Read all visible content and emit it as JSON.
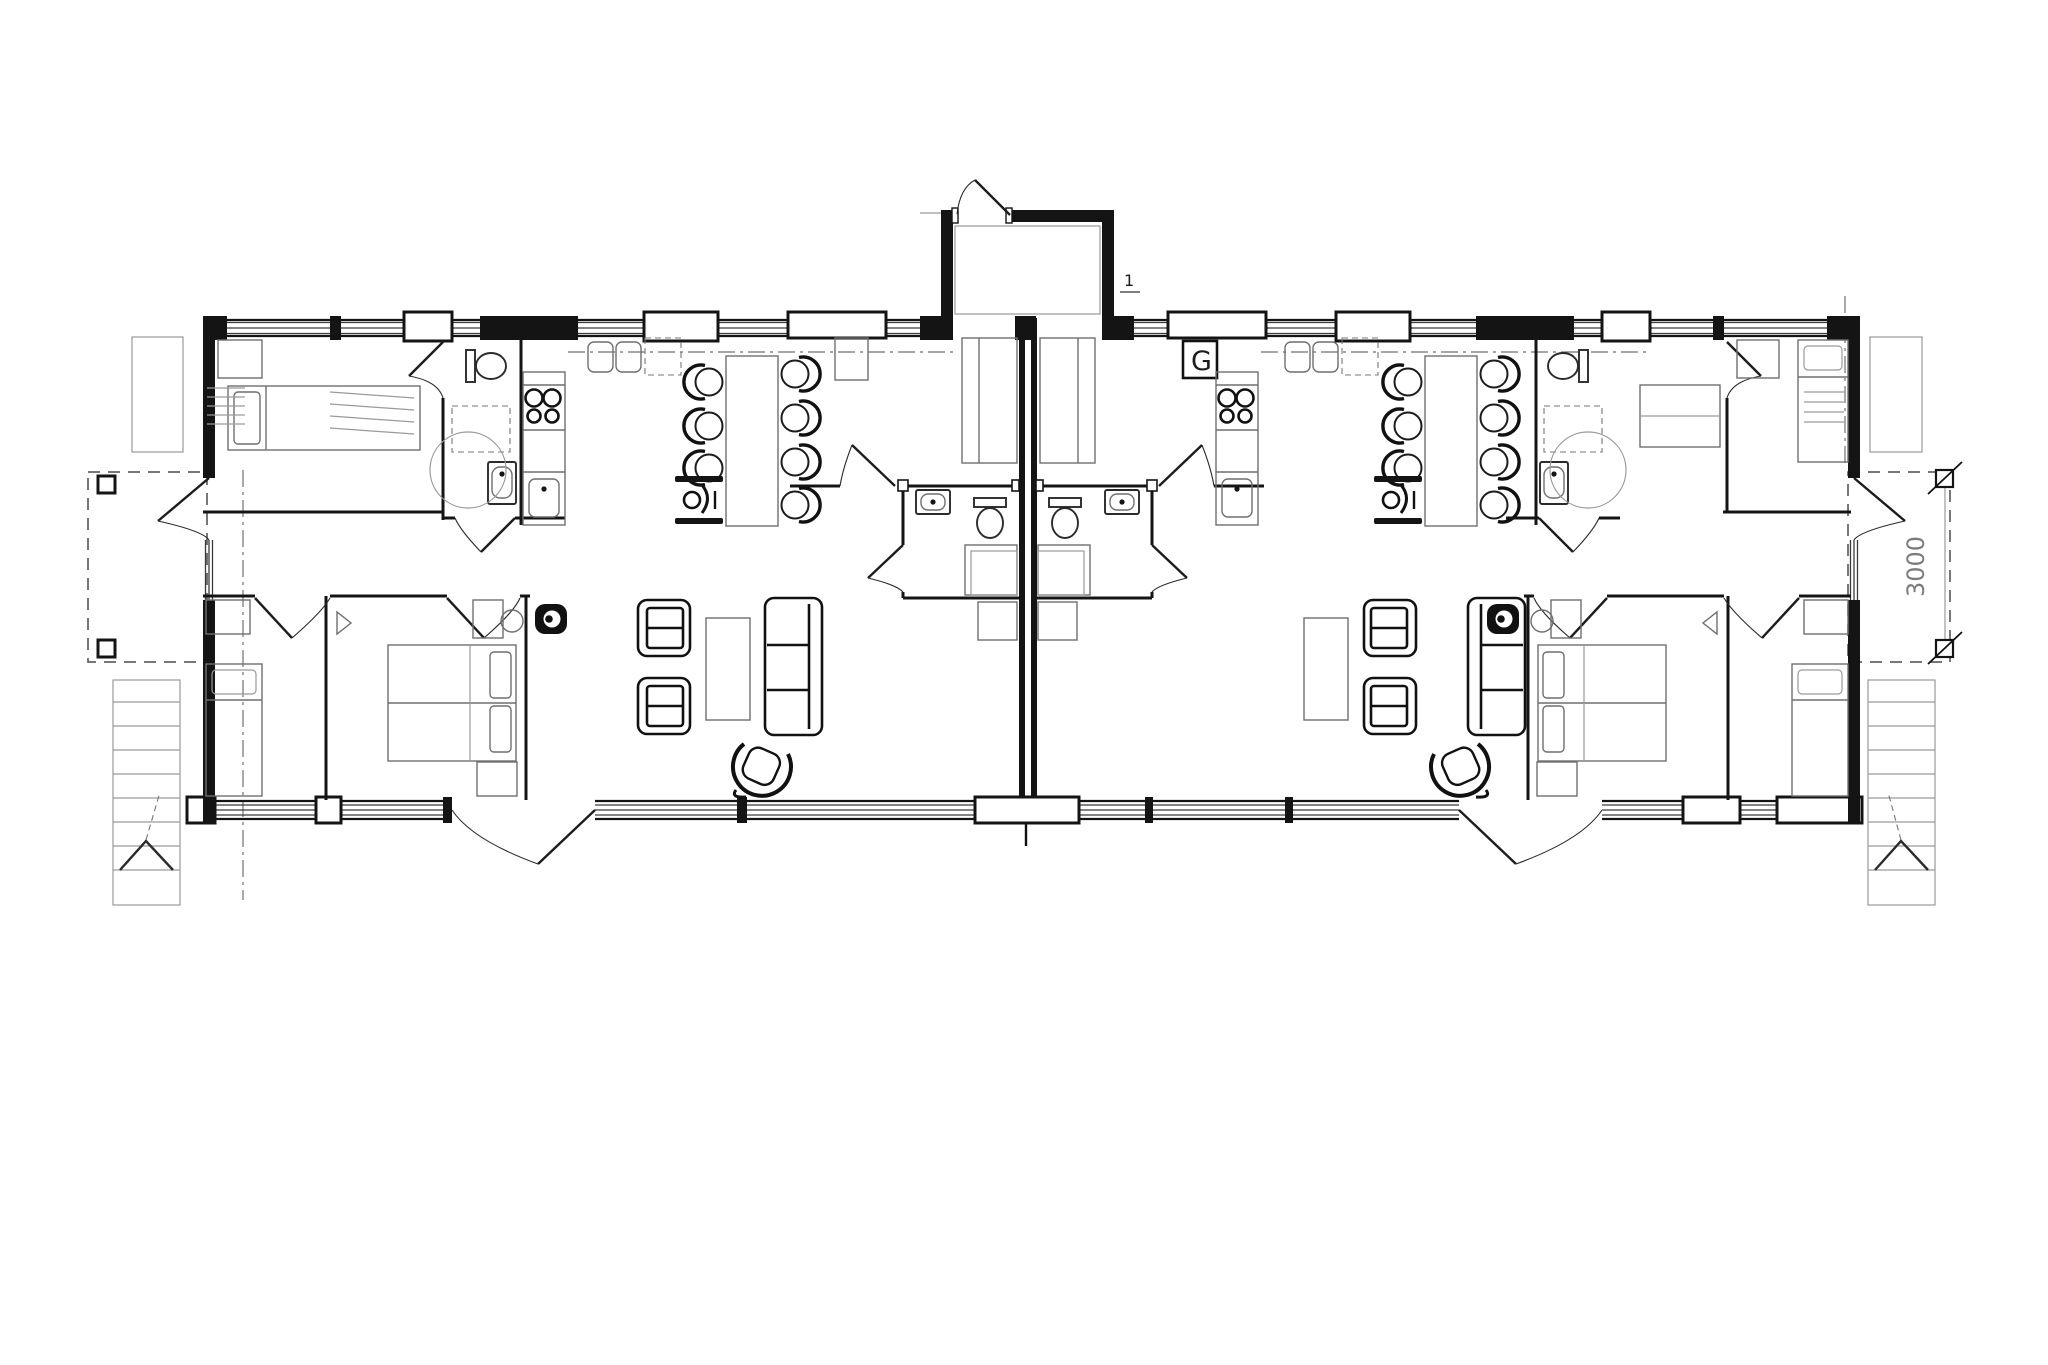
{
  "drawing": {
    "type": "architectural-floor-plan",
    "labels": {
      "wardrobe_right": "G",
      "deck_depth": "3000",
      "door_mark": "1"
    },
    "symbols": [
      "dining-chair-icon",
      "wheelchair-icon",
      "toilet-icon",
      "washbasin-icon",
      "stove-burners-icon",
      "kitchen-sink-icon",
      "sofa-icon",
      "armchair-icon",
      "swivel-chair-icon",
      "double-bed-icon",
      "single-bed-icon",
      "stairs-arrow-icon",
      "turning-circle-icon",
      "wood-stove-icon",
      "deck-post-icon",
      "dimension-tick-icon"
    ],
    "colors": {
      "line": "#141414",
      "furniture": "#6f6f6f",
      "dim": "#7c7c7c",
      "background": "#ffffff"
    }
  }
}
